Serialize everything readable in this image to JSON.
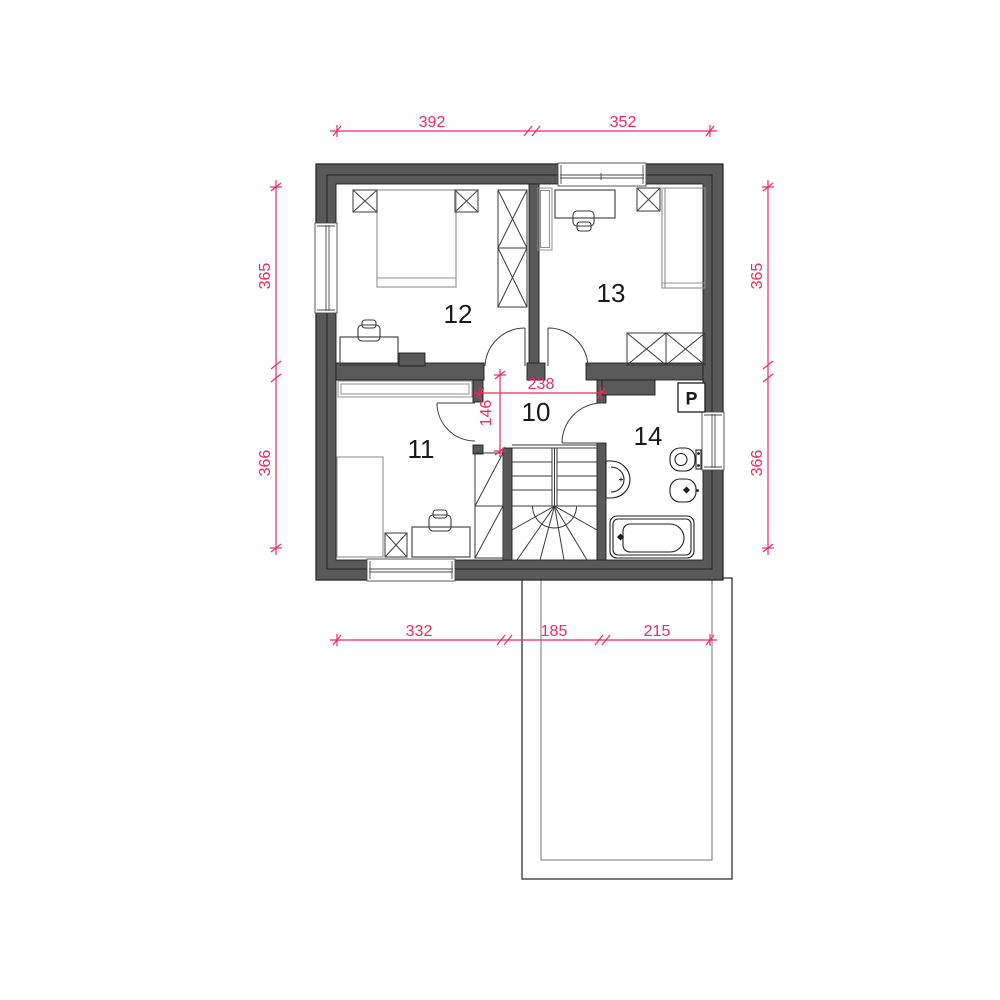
{
  "plan": {
    "room_labels": [
      "10",
      "11",
      "12",
      "13",
      "14"
    ],
    "washing_machine_label": "P",
    "dimensions": {
      "top": [
        "392",
        "352"
      ],
      "bottom": [
        "332",
        "185",
        "215"
      ],
      "left": [
        "365",
        "366"
      ],
      "right": [
        "365",
        "366"
      ],
      "hall_width": "238",
      "hall_depth": "146"
    },
    "colors": {
      "wall": "#595959",
      "dimension_pink": "#ed2b5e",
      "line_dark": "#222222"
    }
  }
}
